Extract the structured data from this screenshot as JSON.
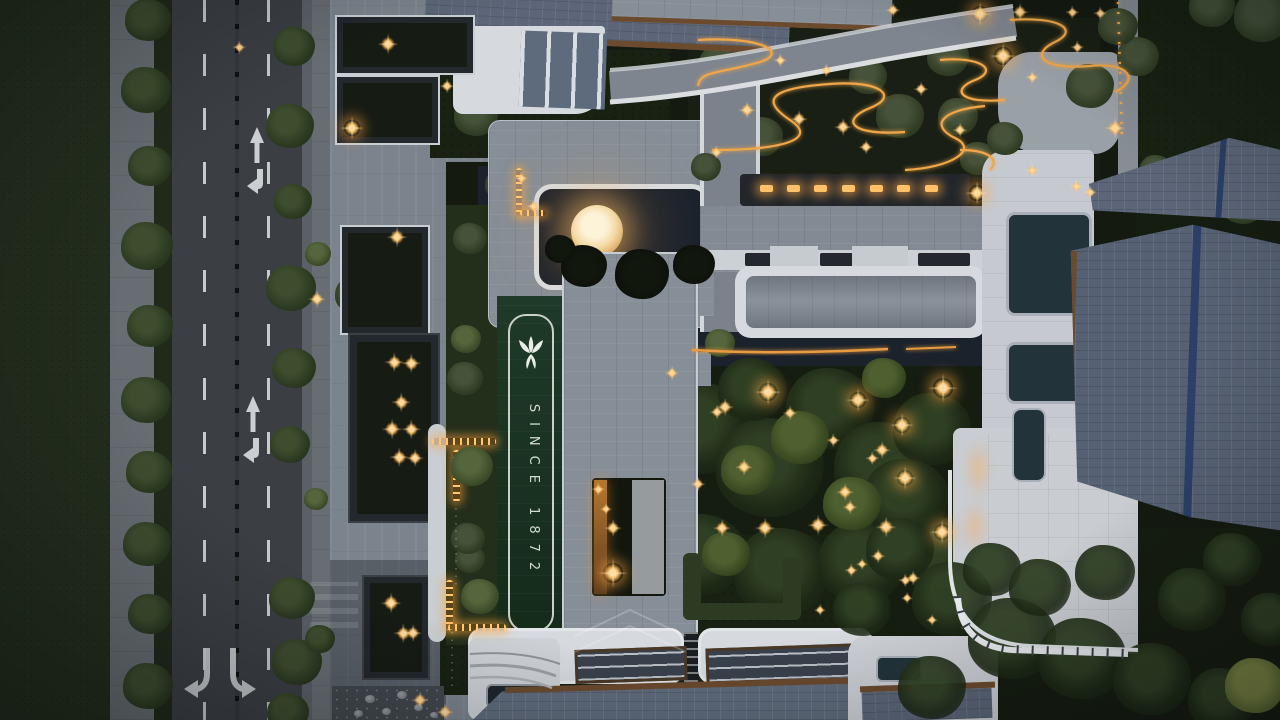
{
  "meta": {
    "description": "Aerial dusk photograph of a residential complex with road, plazas, courtyards and illuminated gardens"
  },
  "banner": {
    "text": "SINCE 1872",
    "logo": "lily-crest-logo"
  },
  "road": {
    "markings": [
      "straight-arrow",
      "left-turn-arrow",
      "dual-turn-arrows",
      "dashed-lane-lines",
      "median-posts"
    ]
  },
  "palette": {
    "grass": "#232d1c",
    "road": "#3b3f43",
    "sidewalk": "#676d72",
    "plaza": "#7b838c",
    "roofGray": "#868e97",
    "roofWhite": "#d6dade",
    "courtyard": "#1b222c",
    "bannerTop": "#1f3a28",
    "bannerBottom": "#142a1a",
    "slate": "#5c6678",
    "navy": "#2b3f68",
    "bronze": "#6b4a2e",
    "amber": "#f0a64a",
    "moon": "#f7dfae",
    "gardenDark": "#141a10",
    "lawn": "#182112",
    "hedge": "#2e3b23"
  },
  "sprites": {
    "veg": [
      [
        148,
        22,
        46,
        "a"
      ],
      [
        146,
        92,
        50,
        "a"
      ],
      [
        150,
        168,
        44,
        "a"
      ],
      [
        147,
        248,
        52,
        "a"
      ],
      [
        150,
        328,
        46,
        "a"
      ],
      [
        146,
        402,
        50,
        "a"
      ],
      [
        149,
        474,
        46,
        "a"
      ],
      [
        147,
        546,
        48,
        "a"
      ],
      [
        150,
        616,
        44,
        "a"
      ],
      [
        148,
        688,
        50,
        "a"
      ],
      [
        294,
        48,
        42,
        "a"
      ],
      [
        290,
        128,
        48,
        "a"
      ],
      [
        293,
        203,
        38,
        "a"
      ],
      [
        291,
        290,
        50,
        "a"
      ],
      [
        294,
        370,
        44,
        "a"
      ],
      [
        290,
        446,
        40,
        "a"
      ],
      [
        292,
        600,
        46,
        "a"
      ],
      [
        297,
        664,
        50,
        "a"
      ],
      [
        288,
        714,
        42,
        "a"
      ],
      [
        318,
        255,
        26,
        "c"
      ],
      [
        316,
        500,
        24,
        "c"
      ],
      [
        320,
        640,
        30,
        "a"
      ],
      [
        362,
        96,
        40,
        "b"
      ],
      [
        420,
        118,
        34,
        "b"
      ],
      [
        355,
        296,
        40,
        "b"
      ],
      [
        398,
        338,
        42,
        "b"
      ],
      [
        368,
        470,
        40,
        "b"
      ],
      [
        406,
        598,
        40,
        "b"
      ],
      [
        380,
        662,
        36,
        "b"
      ],
      [
        476,
        118,
        44,
        "b"
      ],
      [
        540,
        142,
        40,
        "b"
      ],
      [
        502,
        186,
        34,
        "b"
      ],
      [
        560,
        92,
        28,
        "b"
      ],
      [
        722,
        68,
        48,
        "b"
      ],
      [
        762,
        138,
        42,
        "b"
      ],
      [
        900,
        118,
        48,
        "b"
      ],
      [
        948,
        58,
        42,
        "b"
      ],
      [
        868,
        78,
        38,
        "b"
      ],
      [
        1090,
        88,
        48,
        "b"
      ],
      [
        1138,
        58,
        42,
        "b"
      ],
      [
        978,
        160,
        36,
        "b"
      ],
      [
        1262,
        18,
        56,
        "b"
      ],
      [
        1212,
        8,
        46,
        "b"
      ],
      [
        1118,
        28,
        40,
        "b"
      ],
      [
        1200,
        192,
        40,
        "b"
      ],
      [
        1243,
        206,
        44,
        "b"
      ],
      [
        1156,
        172,
        34,
        "b"
      ],
      [
        640,
        382,
        88,
        "g"
      ],
      [
        700,
        432,
        100,
        "g"
      ],
      [
        770,
        472,
        108,
        "g"
      ],
      [
        830,
        412,
        88,
        "g"
      ],
      [
        882,
        470,
        96,
        "g"
      ],
      [
        932,
        432,
        78,
        "g"
      ],
      [
        702,
        558,
        88,
        "g"
      ],
      [
        782,
        576,
        96,
        "g"
      ],
      [
        862,
        566,
        88,
        "g"
      ],
      [
        936,
        556,
        78,
        "g"
      ],
      [
        620,
        470,
        78,
        "g"
      ],
      [
        660,
        522,
        70,
        "g"
      ],
      [
        906,
        502,
        86,
        "g"
      ],
      [
        752,
        392,
        68,
        "g"
      ],
      [
        800,
        440,
        58,
        "gl"
      ],
      [
        748,
        472,
        54,
        "gl"
      ],
      [
        852,
        506,
        58,
        "gl"
      ],
      [
        726,
        556,
        48,
        "gl"
      ],
      [
        884,
        380,
        44,
        "gl"
      ],
      [
        600,
        662,
        30,
        "b"
      ],
      [
        470,
        560,
        30,
        "b"
      ]
    ],
    "overveg": [
      [
        584,
        268,
        46,
        "d"
      ],
      [
        642,
        276,
        54,
        "d"
      ],
      [
        694,
        266,
        42,
        "d"
      ],
      [
        560,
        250,
        30,
        "d"
      ],
      [
        472,
        468,
        42,
        "c"
      ],
      [
        480,
        598,
        38,
        "c"
      ],
      [
        466,
        340,
        30,
        "c"
      ],
      [
        470,
        240,
        34,
        "b"
      ],
      [
        720,
        344,
        30,
        "c"
      ],
      [
        465,
        380,
        36,
        "b"
      ],
      [
        468,
        540,
        34,
        "b"
      ],
      [
        706,
        168,
        30,
        "b"
      ],
      [
        958,
        118,
        40,
        "b"
      ],
      [
        1005,
        140,
        36,
        "b"
      ],
      [
        900,
        552,
        68,
        "g"
      ],
      [
        952,
        602,
        80,
        "g"
      ],
      [
        1012,
        642,
        88,
        "g"
      ],
      [
        1082,
        662,
        88,
        "g"
      ],
      [
        1152,
        682,
        78,
        "g"
      ],
      [
        1222,
        702,
        68,
        "g"
      ],
      [
        932,
        690,
        68,
        "g"
      ],
      [
        862,
        612,
        58,
        "g"
      ],
      [
        992,
        572,
        58,
        "g"
      ],
      [
        1192,
        602,
        68,
        "g"
      ],
      [
        1232,
        562,
        58,
        "g"
      ],
      [
        1270,
        622,
        58,
        "g"
      ],
      [
        1255,
        688,
        60,
        "y"
      ],
      [
        1105,
        575,
        60,
        "g"
      ],
      [
        1040,
        590,
        62,
        "g"
      ]
    ],
    "rocks": [
      [
        370,
        700,
        10
      ],
      [
        386,
        712,
        9
      ],
      [
        402,
        696,
        10
      ],
      [
        418,
        708,
        9
      ],
      [
        434,
        716,
        8
      ],
      [
        358,
        714,
        9
      ],
      [
        1163,
        182,
        12
      ],
      [
        1178,
        196,
        10
      ],
      [
        1150,
        200,
        9
      ]
    ],
    "stars": [
      [
        388,
        44,
        14
      ],
      [
        352,
        128,
        16
      ],
      [
        239,
        47,
        9
      ],
      [
        447,
        86,
        10
      ],
      [
        397,
        237,
        14
      ],
      [
        317,
        299,
        12
      ],
      [
        394,
        362,
        13
      ],
      [
        411,
        363,
        13
      ],
      [
        401,
        402,
        13
      ],
      [
        392,
        429,
        14
      ],
      [
        411,
        429,
        13
      ],
      [
        399,
        457,
        13
      ],
      [
        415,
        458,
        12
      ],
      [
        391,
        603,
        14
      ],
      [
        403,
        633,
        13
      ],
      [
        413,
        633,
        12
      ],
      [
        420,
        700,
        12
      ],
      [
        445,
        712,
        12
      ],
      [
        521,
        178,
        9
      ],
      [
        533,
        206,
        9
      ],
      [
        613,
        528,
        12
      ],
      [
        613,
        573,
        20
      ],
      [
        598,
        489,
        9
      ],
      [
        606,
        509,
        8
      ],
      [
        768,
        392,
        18
      ],
      [
        725,
        407,
        12
      ],
      [
        717,
        412,
        10
      ],
      [
        858,
        400,
        16
      ],
      [
        943,
        388,
        20
      ],
      [
        902,
        425,
        16
      ],
      [
        882,
        450,
        12
      ],
      [
        905,
        478,
        16
      ],
      [
        845,
        492,
        12
      ],
      [
        850,
        507,
        10
      ],
      [
        818,
        525,
        14
      ],
      [
        765,
        528,
        14
      ],
      [
        722,
        528,
        12
      ],
      [
        886,
        527,
        14
      ],
      [
        942,
        532,
        16
      ],
      [
        744,
        467,
        12
      ],
      [
        698,
        484,
        10
      ],
      [
        790,
        413,
        10
      ],
      [
        833,
        440,
        9
      ],
      [
        872,
        458,
        9
      ],
      [
        913,
        578,
        10
      ],
      [
        907,
        598,
        8
      ],
      [
        672,
        373,
        10
      ],
      [
        820,
        610,
        8
      ],
      [
        851,
        570,
        9
      ],
      [
        878,
        556,
        10
      ],
      [
        980,
        14,
        16
      ],
      [
        1003,
        56,
        18
      ],
      [
        747,
        110,
        12
      ],
      [
        799,
        119,
        12
      ],
      [
        843,
        127,
        12
      ],
      [
        866,
        147,
        10
      ],
      [
        921,
        89,
        10
      ],
      [
        1020,
        12,
        12
      ],
      [
        1115,
        128,
        14
      ],
      [
        960,
        130,
        10
      ],
      [
        893,
        10,
        10
      ],
      [
        977,
        193,
        16
      ],
      [
        1076,
        186,
        9
      ],
      [
        1090,
        192,
        9
      ],
      [
        1032,
        170,
        9
      ],
      [
        1072,
        12,
        9
      ],
      [
        1100,
        13,
        9
      ],
      [
        1032,
        77,
        9
      ],
      [
        1077,
        47,
        9
      ],
      [
        716,
        152,
        9
      ],
      [
        780,
        60,
        9
      ],
      [
        826,
        70,
        9
      ],
      [
        905,
        580,
        9
      ],
      [
        862,
        564,
        8
      ],
      [
        932,
        620,
        8
      ]
    ],
    "lamps": [
      [
        766,
        188
      ],
      [
        793,
        188
      ],
      [
        820,
        188
      ],
      [
        848,
        188
      ],
      [
        876,
        188
      ],
      [
        903,
        188
      ],
      [
        931,
        188
      ]
    ]
  }
}
